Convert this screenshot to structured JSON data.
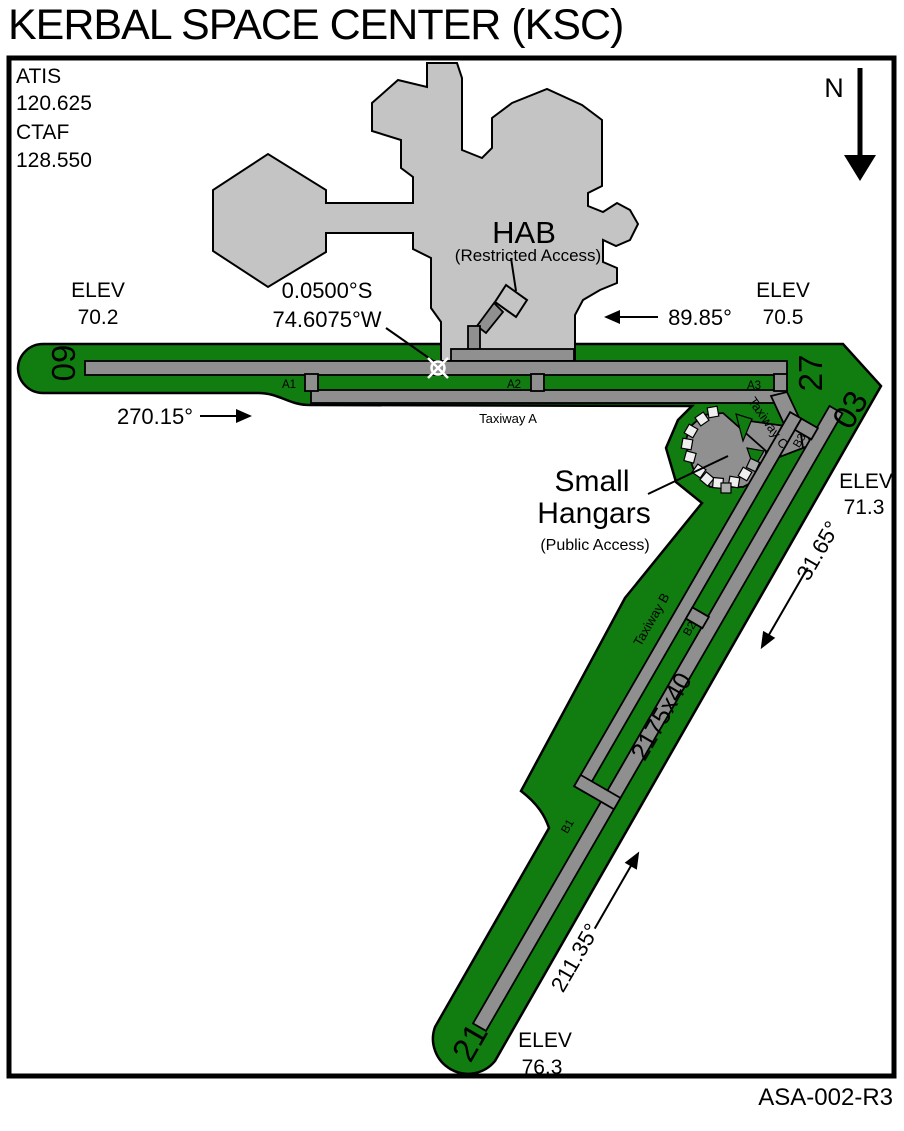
{
  "title": "KERBAL SPACE CENTER (KSC)",
  "doc_ref": "ASA-002-R3",
  "north_label": "N",
  "frequencies": {
    "atis_label": "ATIS",
    "atis_value": "120.625",
    "ctaf_label": "CTAF",
    "ctaf_value": "128.550"
  },
  "reference_point": {
    "lat": "0.0500°S",
    "lon": "74.6075°W"
  },
  "facilities": {
    "hab_name": "HAB",
    "hab_access": "(Restricted Access)",
    "hangars_line1": "Small",
    "hangars_line2": "Hangars",
    "hangars_access": "(Public Access)"
  },
  "elev_label": "ELEV",
  "runway_09_27": {
    "num_west": "09",
    "num_east": "27",
    "heading_west": "270.15°",
    "heading_east": "89.85°",
    "elev_west": "70.2",
    "elev_east": "70.5"
  },
  "runway_03_21": {
    "num_north": "03",
    "num_south": "21",
    "size": "2175x40",
    "heading_ne": "31.65°",
    "heading_sw": "211.35°",
    "elev_north": "71.3",
    "elev_south": "76.3"
  },
  "taxiways": {
    "a": "Taxiway A",
    "b": "Taxiway B",
    "c": "Taxiway C",
    "a1": "A1",
    "a2": "A2",
    "a3": "A3",
    "b1": "B1",
    "b2": "B2",
    "b3": "B3"
  },
  "colors": {
    "grass_green": "#117D11",
    "pavement_gray": "#8F8F8F",
    "building_gray": "#C4C4C4",
    "outline_black": "#000000",
    "marker_white": "#FFFFFF"
  }
}
